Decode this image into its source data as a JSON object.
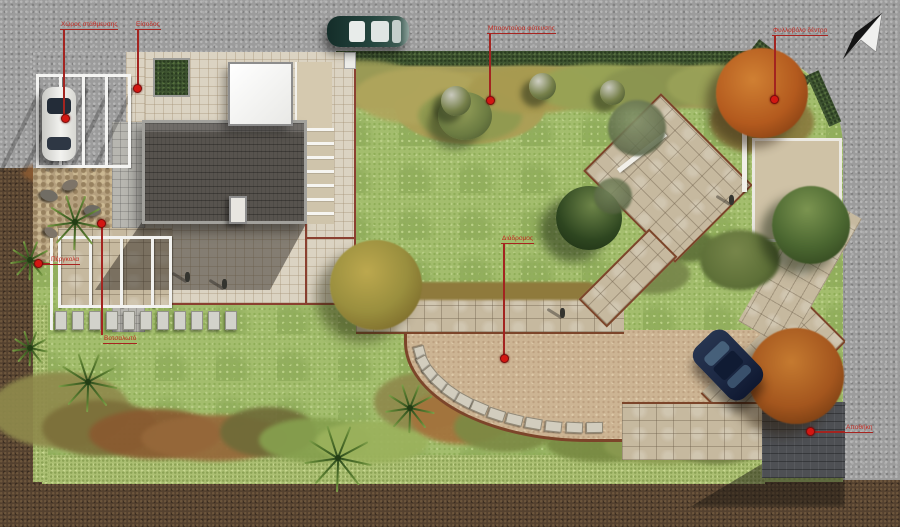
{
  "scene": {
    "type": "residential-garden-landscape-plan-top-view",
    "compass": "north-arrow",
    "vehicles": [
      "teal-car-on-street",
      "white-car-in-carport",
      "navy-car-on-driveway"
    ],
    "people_visible": 4,
    "palette": {
      "concrete": "#9c9c9c",
      "soil": "#54412f",
      "lawn": "#a3bd6d",
      "sand_plaza": "#ccb493",
      "roof": "#57534e",
      "annotation_red": "#c22a22",
      "path_border": "#7c452a",
      "hedge_dark": "#3d5230",
      "hedge_light": "#abbf72"
    }
  },
  "annotations": [
    {
      "id": "parking",
      "label": "Χώρος στάθμευσης"
    },
    {
      "id": "entrance",
      "label": "Είσοδος"
    },
    {
      "id": "planting-border",
      "label": "Μπορντούρα φύτευσης"
    },
    {
      "id": "deciduous-tree",
      "label": "Φυλλοβόλο δέντρο"
    },
    {
      "id": "walkway",
      "label": "Διάδρομος"
    },
    {
      "id": "pebble-garden",
      "label": "Βοτσαλωτό"
    },
    {
      "id": "pergola",
      "label": "Πέργκολα"
    },
    {
      "id": "shed",
      "label": "Αποθήκη"
    }
  ]
}
